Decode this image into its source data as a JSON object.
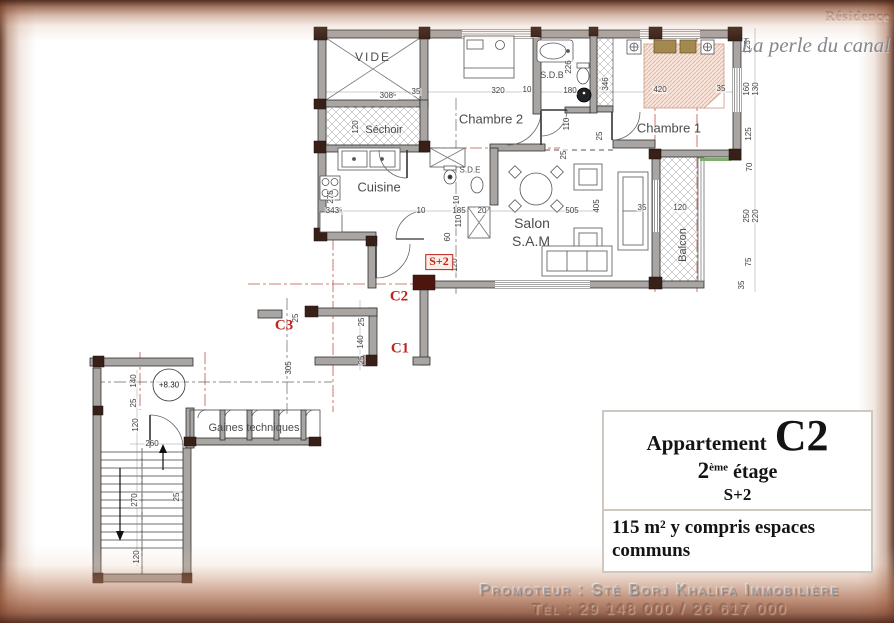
{
  "logo": {
    "brand": "Résidence",
    "tagline": "La perle du canal"
  },
  "colors": {
    "frame_brown": "#6b3a27",
    "label_red": "#c0241c",
    "wall_gray": "#a9a5a2",
    "bed_pink": "#f8e3da",
    "headboard_khaki": "#a3894f",
    "balcony_green": "#7fae6f"
  },
  "plan": {
    "rooms": [
      {
        "label": "VIDE",
        "x": 373,
        "y": 57,
        "fs": 12,
        "ls": 2
      },
      {
        "label": "Séchoir",
        "x": 384,
        "y": 130,
        "fs": 11
      },
      {
        "label": "Chambre 2",
        "x": 491,
        "y": 119,
        "fs": 13
      },
      {
        "label": "S.D.B",
        "x": 552,
        "y": 75,
        "fs": 9
      },
      {
        "label": "Chambre 1",
        "x": 669,
        "y": 128,
        "fs": 13
      },
      {
        "label": "Cuisine",
        "x": 379,
        "y": 187,
        "fs": 13
      },
      {
        "label": "S.D.E",
        "x": 470,
        "y": 170,
        "fs": 8
      },
      {
        "label": "Salon",
        "x": 532,
        "y": 223,
        "fs": 14
      },
      {
        "label": "S.A.M",
        "x": 531,
        "y": 241,
        "fs": 14
      },
      {
        "label": "Balcon",
        "x": 683,
        "y": 245,
        "fs": 11,
        "rot": -90
      },
      {
        "label": "Gaines techniques",
        "x": 254,
        "y": 428,
        "fs": 11
      }
    ],
    "dims": [
      {
        "t": "308⁵",
        "x": 388,
        "y": 96
      },
      {
        "t": "35",
        "x": 416,
        "y": 92
      },
      {
        "t": "320",
        "x": 498,
        "y": 91
      },
      {
        "t": "10",
        "x": 527,
        "y": 90
      },
      {
        "t": "180",
        "x": 570,
        "y": 91
      },
      {
        "t": "420",
        "x": 660,
        "y": 90
      },
      {
        "t": "35",
        "x": 721,
        "y": 89
      },
      {
        "t": "343⁵",
        "x": 334,
        "y": 211
      },
      {
        "t": "10",
        "x": 421,
        "y": 211
      },
      {
        "t": "185",
        "x": 459,
        "y": 211
      },
      {
        "t": "20",
        "x": 482,
        "y": 211
      },
      {
        "t": "505",
        "x": 572,
        "y": 211
      },
      {
        "t": "35",
        "x": 642,
        "y": 208
      },
      {
        "t": "120",
        "x": 680,
        "y": 208
      },
      {
        "t": "260",
        "x": 152,
        "y": 444
      },
      {
        "t": "120",
        "x": 356,
        "y": 127,
        "v": 1
      },
      {
        "t": "275",
        "x": 331,
        "y": 197,
        "v": 1
      },
      {
        "t": "226",
        "x": 569,
        "y": 67,
        "v": 1
      },
      {
        "t": "346",
        "x": 606,
        "y": 84,
        "v": 1
      },
      {
        "t": "110",
        "x": 567,
        "y": 124,
        "v": 1
      },
      {
        "t": "25",
        "x": 600,
        "y": 136,
        "v": 1
      },
      {
        "t": "10",
        "x": 457,
        "y": 200,
        "v": 1
      },
      {
        "t": "110",
        "x": 459,
        "y": 221,
        "v": 1
      },
      {
        "t": "60",
        "x": 448,
        "y": 237,
        "v": 1
      },
      {
        "t": "120",
        "x": 455,
        "y": 265,
        "v": 1
      },
      {
        "t": "25",
        "x": 564,
        "y": 155,
        "v": 1
      },
      {
        "t": "405",
        "x": 597,
        "y": 206,
        "v": 1
      },
      {
        "t": "25",
        "x": 362,
        "y": 322,
        "v": 1
      },
      {
        "t": "140",
        "x": 361,
        "y": 342,
        "v": 1
      },
      {
        "t": "25",
        "x": 362,
        "y": 360,
        "v": 1
      },
      {
        "t": "25",
        "x": 296,
        "y": 318,
        "v": 1
      },
      {
        "t": "305",
        "x": 289,
        "y": 368,
        "v": 1
      },
      {
        "t": "140",
        "x": 134,
        "y": 381,
        "v": 1
      },
      {
        "t": "25",
        "x": 134,
        "y": 403,
        "v": 1
      },
      {
        "t": "120",
        "x": 136,
        "y": 425,
        "v": 1
      },
      {
        "t": "270",
        "x": 135,
        "y": 500,
        "v": 1
      },
      {
        "t": "25",
        "x": 177,
        "y": 497,
        "v": 1
      },
      {
        "t": "120",
        "x": 137,
        "y": 557,
        "v": 1
      },
      {
        "t": "125",
        "x": 748,
        "y": 47,
        "v": 1
      },
      {
        "t": "160",
        "x": 747,
        "y": 89,
        "v": 1
      },
      {
        "t": "130",
        "x": 756,
        "y": 89,
        "v": 1
      },
      {
        "t": "125",
        "x": 749,
        "y": 134,
        "v": 1
      },
      {
        "t": "70",
        "x": 750,
        "y": 167,
        "v": 1
      },
      {
        "t": "250",
        "x": 747,
        "y": 216,
        "v": 1
      },
      {
        "t": "220",
        "x": 756,
        "y": 216,
        "v": 1
      },
      {
        "t": "75",
        "x": 749,
        "y": 262,
        "v": 1
      },
      {
        "t": "35",
        "x": 742,
        "y": 285,
        "v": 1
      }
    ],
    "markers": [
      {
        "label": "C2",
        "x": 399,
        "y": 297,
        "style": "red"
      },
      {
        "label": "C1",
        "x": 400,
        "y": 349,
        "style": "red"
      },
      {
        "label": "C3",
        "x": 284,
        "y": 326,
        "style": "red"
      },
      {
        "label": "S+2",
        "x": 439,
        "y": 262,
        "style": "red-box"
      },
      {
        "label": "+8.30",
        "x": 169,
        "y": 385,
        "style": "level"
      }
    ]
  },
  "info_box": {
    "title": "Appartement",
    "unit": "C2",
    "floor_number": "2",
    "floor_ordinal": "ème",
    "floor_label": "étage",
    "scheme": "S+2",
    "area": "115 m² y compris espaces communs"
  },
  "footer": {
    "promoter": "Promoteur : Sté Borj Khalifa Immobilière",
    "phone": "Tél : 29 148 000 / 26 617 000"
  }
}
